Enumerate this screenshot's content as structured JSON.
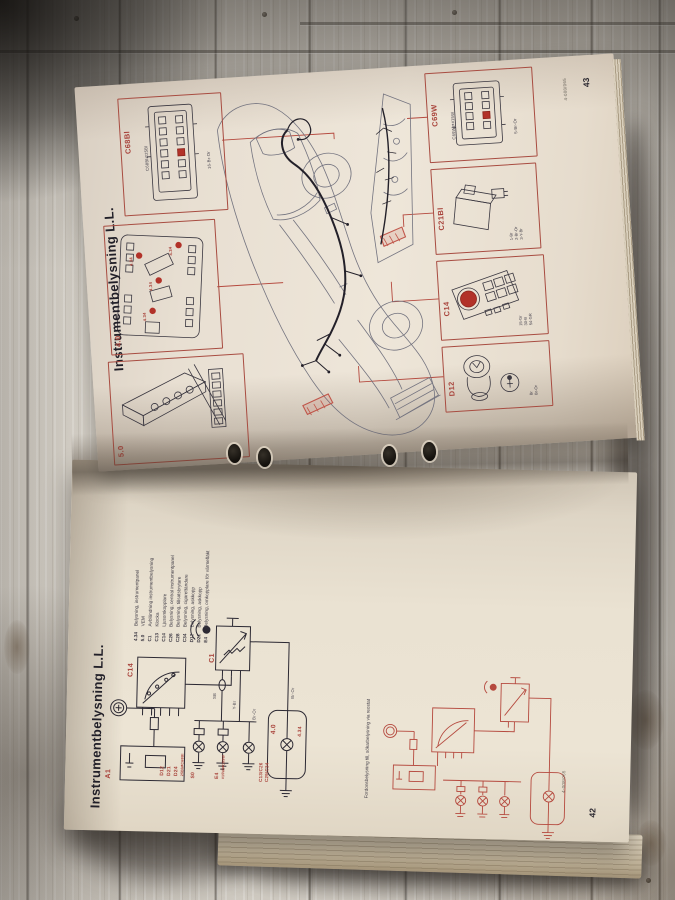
{
  "book": {
    "page43": {
      "title": "Instrumentbelysning L.L.",
      "page_number": "43",
      "doc_code": "4-008/065",
      "c68bl": {
        "label": "C68Bl",
        "sub": "C68Bl⇄25Bl",
        "wire": "16-Br-Or"
      },
      "panel": {
        "label": "4.0",
        "dot": "4.34"
      },
      "cluster": {
        "label": "5.0"
      },
      "c69w": {
        "label": "C69W",
        "sub": "C69W⇄#15W",
        "wire": "5-Br-Or"
      },
      "c21bl": {
        "label": "C21Bl",
        "wires": [
          "1-Br",
          "2-Br-Or",
          "3-Y-Br"
        ]
      },
      "c14": {
        "label": "C14",
        "wires": [
          "15-Gr",
          "30-B",
          "54-GR"
        ]
      },
      "d12": {
        "label": "D12",
        "wires": [
          "Br",
          "Br-Or"
        ]
      }
    },
    "page42": {
      "title": "Instrumentbelysning L.L.",
      "page_number": "42",
      "doc_code": "4-008/065",
      "legend": [
        {
          "code": "4.34",
          "label": "Belysning, instrumentpanel"
        },
        {
          "code": "5.0",
          "label": "VEM"
        },
        {
          "code": "C1",
          "label": "Avbländning instrumentbelysning"
        },
        {
          "code": "C13",
          "label": "Klocka"
        },
        {
          "code": "C14",
          "label": "Ljusomkopplare"
        },
        {
          "code": "C26",
          "label": "Belysning, central instrumentpanel"
        },
        {
          "code": "C28",
          "label": "Belysning, tillsatsbrytare"
        },
        {
          "code": "C34",
          "label": "Belysning, cigarettändare"
        },
        {
          "code": "D12",
          "label": "Belysning, askkopp"
        },
        {
          "code": "D21",
          "label": "Belysning, askkopp"
        },
        {
          "code": "E4",
          "label": "Belysning, omkopplare för värmefläkt"
        }
      ],
      "labels": {
        "a1": "A1",
        "c14": "C14",
        "c1": "C1",
        "sb": "SB",
        "y_br": "Y-Br",
        "br_or": "Br-Or",
        "d12": "D12",
        "d21": "D21",
        "d24": "D24",
        "d24_sub": "25Bl⇄C68Bl",
        "s0": "S0",
        "e4": "E4",
        "e4_sub": "#15W⇄C69W",
        "c13_c26": "C13/C26",
        "c29_c34": "C29/C34",
        "n40": "4.0",
        "n434": "4.34"
      },
      "caption": "Fordonsbelysning till, sökarbelysning via reostat"
    }
  }
}
